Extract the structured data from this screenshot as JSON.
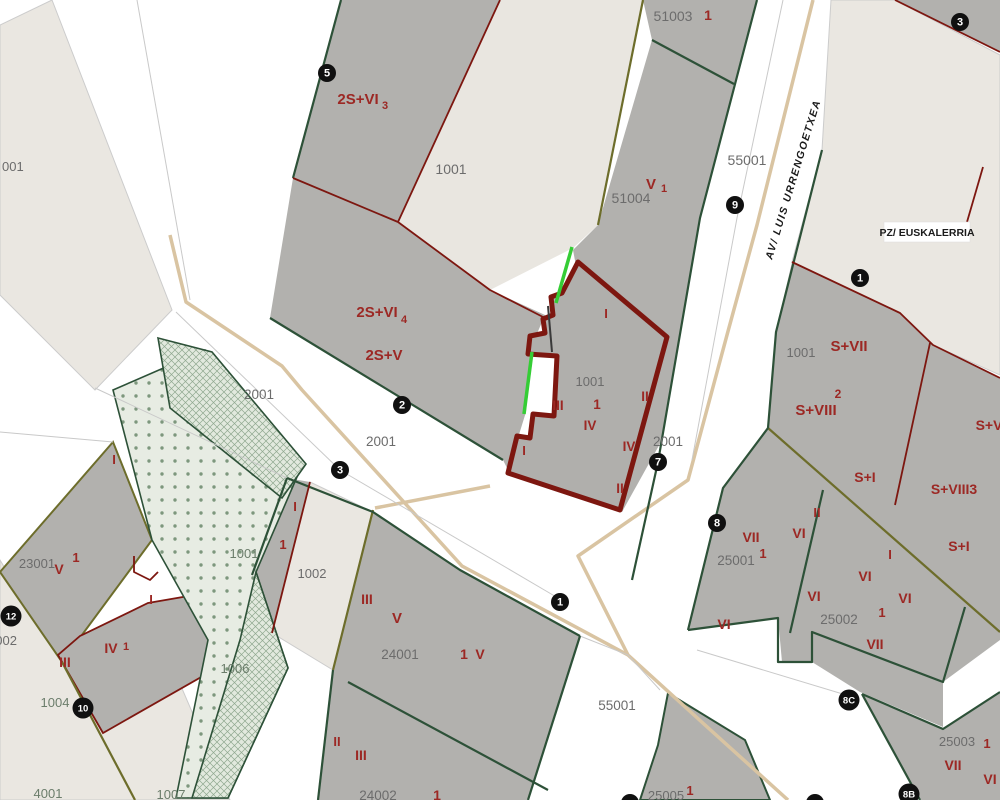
{
  "map": {
    "title": "cadastral-parcel-map",
    "selected_parcel": "1001",
    "colors": {
      "road_white": "#ffffff",
      "parcel_beige": "#eae7e1",
      "block_gray": "#b2b1ae",
      "light_parcel": "#e9e6e0",
      "boundary_red": "#7d1710",
      "label_red": "#9c2824",
      "boundary_green": "#2d5138",
      "boundary_olive": "#6d6d2b",
      "boundary_tan": "#d9c4a2",
      "selection_green": "#35cd35",
      "park_dots": "#7d977d",
      "circle_black": "#101010"
    },
    "streets": [
      {
        "t": "AV/ LUIS URRENGOETXEA",
        "x": 772,
        "y": 260,
        "c": "street",
        "s": 10.5,
        "a": "start",
        "r": -73
      },
      {
        "t": "PZ/ EUSKALERRIA",
        "x": 927,
        "y": 236,
        "c": "z",
        "s": 10.5,
        "a": "middle",
        "r": 0
      }
    ],
    "labels": [
      {
        "t": "001",
        "x": 2,
        "y": 171,
        "c": "p",
        "s": 13,
        "a": "start"
      },
      {
        "t": "2S+VI",
        "x": 358,
        "y": 104,
        "c": "f",
        "s": 15
      },
      {
        "t": "3",
        "x": 385,
        "y": 109,
        "c": "f",
        "s": 11
      },
      {
        "t": "1001",
        "x": 451,
        "y": 174,
        "c": "p",
        "s": 14
      },
      {
        "t": "51003",
        "x": 673,
        "y": 21,
        "c": "p",
        "s": 14
      },
      {
        "t": "1",
        "x": 708,
        "y": 20,
        "c": "f",
        "s": 14
      },
      {
        "t": "V",
        "x": 651,
        "y": 189,
        "c": "f",
        "s": 15
      },
      {
        "t": "1",
        "x": 664,
        "y": 192,
        "c": "f",
        "s": 11
      },
      {
        "t": "51004",
        "x": 631,
        "y": 203,
        "c": "p",
        "s": 14
      },
      {
        "t": "55001",
        "x": 747,
        "y": 165,
        "c": "p",
        "s": 14
      },
      {
        "t": "2S+VI",
        "x": 377,
        "y": 317,
        "c": "f",
        "s": 15
      },
      {
        "t": "4",
        "x": 404,
        "y": 323,
        "c": "f",
        "s": 11
      },
      {
        "t": "2S+V",
        "x": 384,
        "y": 360,
        "c": "f",
        "s": 15
      },
      {
        "t": "2001",
        "x": 259,
        "y": 399,
        "c": "p",
        "s": 13.5
      },
      {
        "t": "2001",
        "x": 381,
        "y": 446,
        "c": "p",
        "s": 13.5
      },
      {
        "t": "2001",
        "x": 668,
        "y": 446,
        "c": "p",
        "s": 13.5
      },
      {
        "t": "I",
        "x": 606,
        "y": 318,
        "c": "f",
        "s": 13
      },
      {
        "t": "1001",
        "x": 590,
        "y": 386,
        "c": "p",
        "s": 13
      },
      {
        "t": "1",
        "x": 597,
        "y": 409,
        "c": "f",
        "s": 13.5
      },
      {
        "t": "III",
        "x": 558,
        "y": 410,
        "c": "f",
        "s": 13.5
      },
      {
        "t": "IV",
        "x": 590,
        "y": 430,
        "c": "f",
        "s": 13.5
      },
      {
        "t": "II",
        "x": 645,
        "y": 401,
        "c": "f",
        "s": 13.5
      },
      {
        "t": "I",
        "x": 524,
        "y": 455,
        "c": "f",
        "s": 13
      },
      {
        "t": "IV",
        "x": 629,
        "y": 451,
        "c": "f",
        "s": 13.5
      },
      {
        "t": "II",
        "x": 620,
        "y": 493,
        "c": "f",
        "s": 13.5
      },
      {
        "t": "1001",
        "x": 801,
        "y": 357,
        "c": "p",
        "s": 13
      },
      {
        "t": "S+VII",
        "x": 849,
        "y": 351,
        "c": "f",
        "s": 15
      },
      {
        "t": "2",
        "x": 838,
        "y": 398,
        "c": "f",
        "s": 12
      },
      {
        "t": "S+VIII",
        "x": 816,
        "y": 415,
        "c": "f",
        "s": 15
      },
      {
        "t": "S+V",
        "x": 989,
        "y": 430,
        "c": "f",
        "s": 14
      },
      {
        "t": "S+I",
        "x": 865,
        "y": 482,
        "c": "f",
        "s": 14
      },
      {
        "t": "S+VIII3",
        "x": 954,
        "y": 494,
        "c": "f",
        "s": 14
      },
      {
        "t": "II",
        "x": 817,
        "y": 517,
        "c": "f",
        "s": 13
      },
      {
        "t": "VI",
        "x": 799,
        "y": 538,
        "c": "f",
        "s": 14
      },
      {
        "t": "S+I",
        "x": 959,
        "y": 551,
        "c": "f",
        "s": 14
      },
      {
        "t": "VII",
        "x": 751,
        "y": 542,
        "c": "f",
        "s": 14
      },
      {
        "t": "1",
        "x": 763,
        "y": 558,
        "c": "f",
        "s": 13
      },
      {
        "t": "25001",
        "x": 736,
        "y": 565,
        "c": "p",
        "s": 13.5
      },
      {
        "t": "VI",
        "x": 724,
        "y": 629,
        "c": "f",
        "s": 14
      },
      {
        "t": "I",
        "x": 890,
        "y": 559,
        "c": "f",
        "s": 13
      },
      {
        "t": "VI",
        "x": 865,
        "y": 581,
        "c": "f",
        "s": 14
      },
      {
        "t": "VI",
        "x": 905,
        "y": 603,
        "c": "f",
        "s": 14
      },
      {
        "t": "VI",
        "x": 814,
        "y": 601,
        "c": "f",
        "s": 14
      },
      {
        "t": "1",
        "x": 882,
        "y": 617,
        "c": "f",
        "s": 13
      },
      {
        "t": "25002",
        "x": 839,
        "y": 624,
        "c": "p",
        "s": 13.5
      },
      {
        "t": "VII",
        "x": 875,
        "y": 649,
        "c": "f",
        "s": 14
      },
      {
        "t": "I",
        "x": 114,
        "y": 464,
        "c": "f",
        "s": 13
      },
      {
        "t": "23001",
        "x": 37,
        "y": 568,
        "c": "p",
        "s": 13
      },
      {
        "t": "V",
        "x": 59,
        "y": 574,
        "c": "f",
        "s": 14
      },
      {
        "t": "1",
        "x": 76,
        "y": 562,
        "c": "f",
        "s": 13
      },
      {
        "t": "1002",
        "x": -12,
        "y": 645,
        "c": "p",
        "s": 13,
        "a": "start"
      },
      {
        "t": "I",
        "x": 151,
        "y": 604,
        "c": "f",
        "s": 13
      },
      {
        "t": "III",
        "x": 65,
        "y": 667,
        "c": "f",
        "s": 14
      },
      {
        "t": "IV",
        "x": 111,
        "y": 653,
        "c": "f",
        "s": 14
      },
      {
        "t": "1",
        "x": 126,
        "y": 650,
        "c": "f",
        "s": 11
      },
      {
        "t": "1004",
        "x": 55,
        "y": 707,
        "c": "r",
        "s": 13
      },
      {
        "t": "4001",
        "x": 48,
        "y": 798,
        "c": "r",
        "s": 13
      },
      {
        "t": "1007",
        "x": 171,
        "y": 799,
        "c": "r",
        "s": 13
      },
      {
        "t": "1006",
        "x": 235,
        "y": 673,
        "c": "r",
        "s": 13
      },
      {
        "t": "1001",
        "x": 244,
        "y": 558,
        "c": "r",
        "s": 13
      },
      {
        "t": "I",
        "x": 295,
        "y": 511,
        "c": "f",
        "s": 13
      },
      {
        "t": "1",
        "x": 283,
        "y": 549,
        "c": "f",
        "s": 13
      },
      {
        "t": "1002",
        "x": 312,
        "y": 578,
        "c": "p",
        "s": 13
      },
      {
        "t": "III",
        "x": 367,
        "y": 604,
        "c": "f",
        "s": 14
      },
      {
        "t": "V",
        "x": 397,
        "y": 623,
        "c": "f",
        "s": 15
      },
      {
        "t": "24001",
        "x": 400,
        "y": 659,
        "c": "p",
        "s": 13.5
      },
      {
        "t": "1",
        "x": 464,
        "y": 659,
        "c": "f",
        "s": 14
      },
      {
        "t": "V",
        "x": 480,
        "y": 659,
        "c": "f",
        "s": 14
      },
      {
        "t": "II",
        "x": 337,
        "y": 746,
        "c": "f",
        "s": 13
      },
      {
        "t": "III",
        "x": 361,
        "y": 760,
        "c": "f",
        "s": 14
      },
      {
        "t": "24002",
        "x": 378,
        "y": 800,
        "c": "p",
        "s": 13.5
      },
      {
        "t": "1",
        "x": 437,
        "y": 800,
        "c": "f",
        "s": 14
      },
      {
        "t": "55001",
        "x": 617,
        "y": 710,
        "c": "p",
        "s": 13.5
      },
      {
        "t": "25005",
        "x": 666,
        "y": 800,
        "c": "p",
        "s": 13
      },
      {
        "t": "1",
        "x": 690,
        "y": 795,
        "c": "f",
        "s": 13
      },
      {
        "t": "25003",
        "x": 957,
        "y": 746,
        "c": "p",
        "s": 13
      },
      {
        "t": "1",
        "x": 987,
        "y": 748,
        "c": "f",
        "s": 13
      },
      {
        "t": "VII",
        "x": 953,
        "y": 770,
        "c": "f",
        "s": 14
      },
      {
        "t": "VI",
        "x": 990,
        "y": 784,
        "c": "f",
        "s": 14
      }
    ],
    "address_circles": [
      {
        "t": "5",
        "x": 327,
        "y": 73
      },
      {
        "t": "3",
        "x": 960,
        "y": 22
      },
      {
        "t": "9",
        "x": 735,
        "y": 205
      },
      {
        "t": "1",
        "x": 860,
        "y": 278
      },
      {
        "t": "2",
        "x": 402,
        "y": 405
      },
      {
        "t": "3",
        "x": 340,
        "y": 470
      },
      {
        "t": "7",
        "x": 658,
        "y": 462
      },
      {
        "t": "1",
        "x": 560,
        "y": 602
      },
      {
        "t": "8",
        "x": 717,
        "y": 523
      },
      {
        "t": "12",
        "x": 11,
        "y": 616
      },
      {
        "t": "10",
        "x": 83,
        "y": 708
      },
      {
        "t": "8C",
        "x": 849,
        "y": 700
      },
      {
        "t": "8B",
        "x": 909,
        "y": 794
      },
      {
        "t": "",
        "x": 630,
        "y": 803
      },
      {
        "t": "",
        "x": 815,
        "y": 803
      }
    ]
  }
}
